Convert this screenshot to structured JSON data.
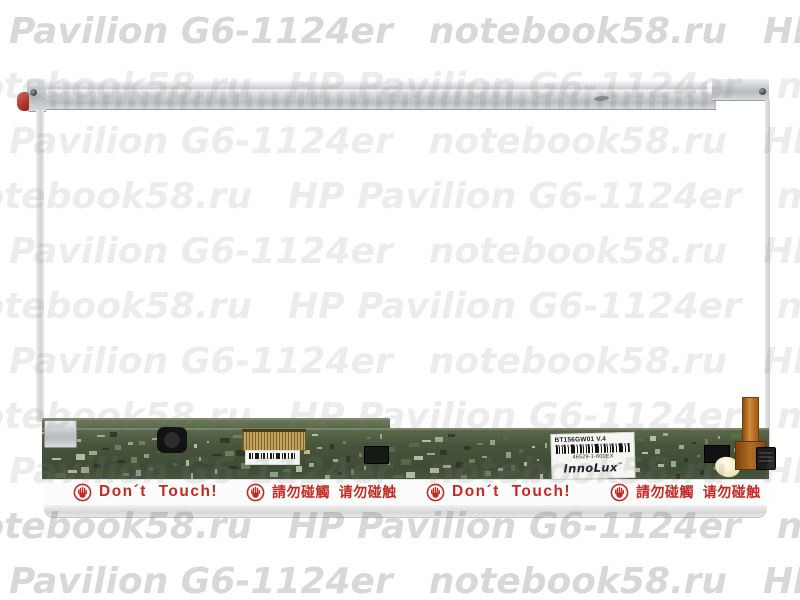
{
  "watermark": {
    "brand": "HP Pavilion G6-1124er",
    "site": "notebook58.ru",
    "rgb": "125,125,125"
  },
  "panel_label": {
    "model": "BT156GW01  V.4",
    "serial": "46529-1-600EX",
    "logo": "InnoLux",
    "tm": "™"
  },
  "warnings": {
    "color": "#c22a22",
    "items": [
      {
        "text": "Don´t  Touch!"
      },
      {
        "text": "請勿碰觸  请勿碰触"
      },
      {
        "text": "Don´t  Touch!"
      },
      {
        "text": "請勿碰觸  请勿碰触"
      }
    ]
  }
}
